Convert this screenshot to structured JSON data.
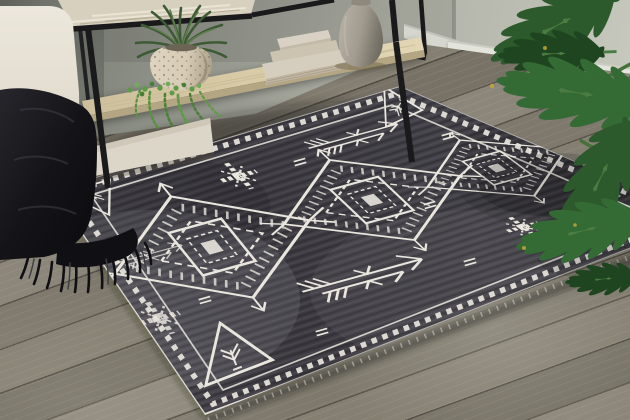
{
  "scene": {
    "description": "Lifestyle product photograph of a charcoal gray area rug with an ivory Southwestern tribal pattern, shown on gray-brown wood plank flooring in a living room with a black metal console table, decorative vase, stacked books, potted plants, a cream sofa with a black fringed throw blanket, and a philodendron plant in the foreground",
    "objects": [
      "area rug",
      "console table",
      "stoneware vase",
      "stacked decorative books",
      "speckled planter with spiky plant",
      "string of pearls trailing plant",
      "cream sofa",
      "black fringed throw blanket",
      "philodendron floor plant",
      "wood plank floor",
      "wall with baseboard"
    ]
  },
  "rug": {
    "style": "Southwestern tribal / Moroccan",
    "field_color": "#413f45",
    "pattern_color": "#e9e6de",
    "medallion_count": 3,
    "motifs": [
      "diamond medallions with serrated edges",
      "stepped center squares",
      "corner triangles with branch glyphs",
      "feathered arrows",
      "pixel cross snowflakes",
      "checkered chain border"
    ]
  },
  "palette": {
    "wall_dark": "#5e615a",
    "wall_a": "#82857c",
    "wall_b": "#a2a49a",
    "wall_c": "#c0c2b7",
    "baseboard": "#e3e4db",
    "floor_a": "#857f72",
    "floor_b": "#5f5a50",
    "rug_field": "#413f45",
    "rug_field_dk": "#2c2b30",
    "rug_pattern": "#e9e6de",
    "metal": "#1a191c",
    "wood_top": "#d8d0bf",
    "shelf": "#d8cba6",
    "shelf_edge": "#b4a683",
    "vase_a": "#b6b0a4",
    "vase_b": "#6b665c",
    "book": "#d5cdbd",
    "pot": "#d7ccb6",
    "leaf": "#2d5a2c",
    "leaf_mid": "#346a34",
    "leaf_dk": "#1e4520",
    "leaf_rib": "#4a7c42",
    "pearls": "#5f9a47",
    "sofa": "#e4ded1",
    "sofa_shade": "#cdc6b6",
    "throw": "#141418"
  }
}
